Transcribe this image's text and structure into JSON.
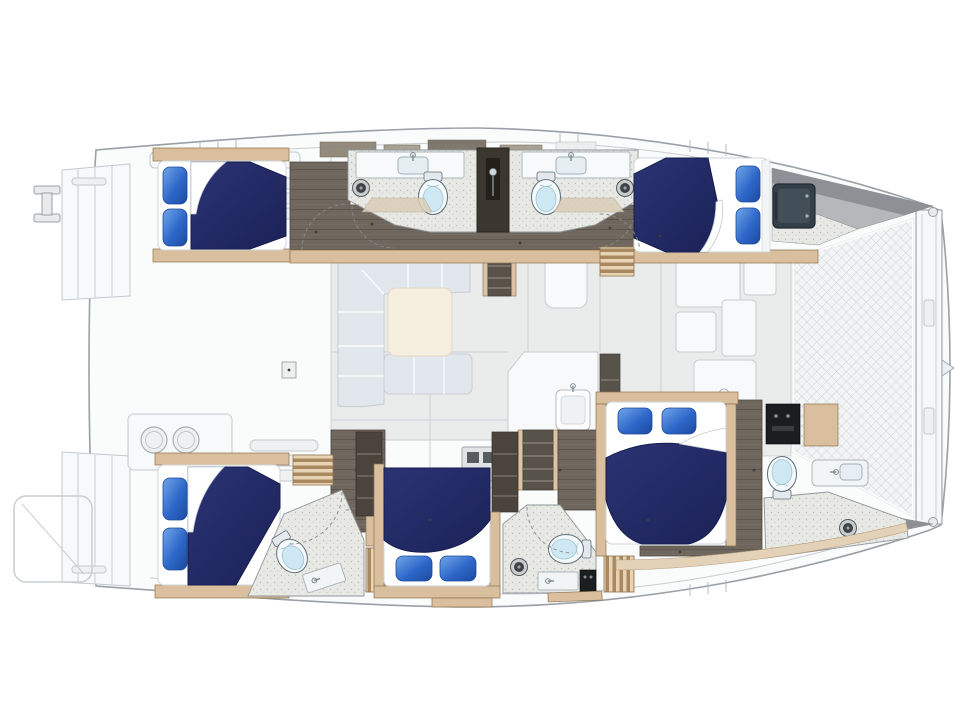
{
  "meta": {
    "type": "floorplan",
    "subject": "sailing-catamaran-interior-deck-plan",
    "orientation": "bow-right-stern-left",
    "hulls": [
      "port-top",
      "starboard-bottom"
    ]
  },
  "colors": {
    "bg": "#ffffff",
    "outline": "#9aa0a5",
    "outlineSoft": "#c9cdd1",
    "ghostFill": "#fafbfb",
    "ghostPanel": "#eef0f1",
    "ghostLine": "#c3c9cd",
    "floorGhost": "#e9eaea",
    "tramp": "#f3f4f5",
    "trampLine": "#c8ccd0",
    "beamFill": "#f6f7f8",
    "wedgeDark": "#8d9195",
    "wedgeMid": "#b4b8bb",
    "cabinFloor": "#6f675e",
    "plankLine": "#5e564d",
    "bathFloor": "#e8e9e5",
    "bathSpeck": "#b9bbb6",
    "bathLine": "#8f969b",
    "wood": "#d9bf9d",
    "woodDeep": "#c3a071",
    "woodLine": "#8f7350",
    "ribLight": "#e8d4b4",
    "ribDark": "#a98a60",
    "navy": "#222a66",
    "navyDeep": "#161d4d",
    "pillowHi": "#72a7e8",
    "pillowLo": "#1b4a9e",
    "sheet": "#ffffff",
    "sheetShade": "#cfd4d8",
    "stepsDark": "#4a443c",
    "stepsTread": "#7b7266",
    "sofa": "#dfe6ec",
    "sofaLine": "#ffffff",
    "tableTop": "#f6eedd",
    "counter": "#fafbfc",
    "stove": "#dfe2e4",
    "darkPanel": "#1c1d1f",
    "hatch": "#333f49",
    "hatchHi": "#46545e",
    "toiletSeat": "#cfe9f4",
    "fixtureLine": "#5f6f79",
    "arc": "#8a8a8a"
  },
  "inventory": {
    "cabins": 5,
    "double_berths": 5,
    "pillows_per_berth": 2,
    "heads_bathrooms": 5,
    "toilets": 5,
    "shower_drains": 5,
    "vanity_sinks": 6,
    "companionway_stairs": 2,
    "ribbed_step_blocks": 4,
    "salon_sofa": 1,
    "salon_table": 1,
    "galley_stove": 1,
    "galley_island_sink": 1,
    "cockpit_grill_burners": 2,
    "bow_trampoline": 1,
    "stern_swim_platforms": 2,
    "forward_hatch_tv": 1
  }
}
